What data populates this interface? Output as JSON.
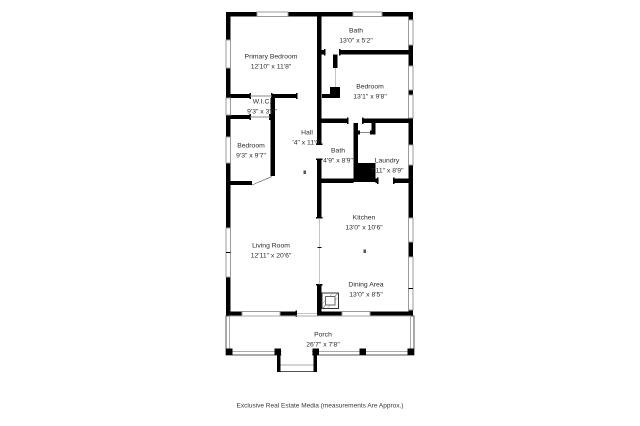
{
  "colors": {
    "wall": "#000000",
    "window_line": "#9b9b9b",
    "text": "#2b2b2b",
    "background": "#ffffff"
  },
  "rooms": [
    {
      "id": "bath-top",
      "name": "Bath",
      "dims": "13'0\" x 5'2\""
    },
    {
      "id": "primary-bedroom",
      "name": "Primary Bedroom",
      "dims": "12'10\" x 11'8\""
    },
    {
      "id": "bedroom-right",
      "name": "Bedroom",
      "dims": "13'1\" x 9'8\""
    },
    {
      "id": "wic",
      "name": "W.I.C.",
      "dims": "9'3\" x 3'0\""
    },
    {
      "id": "hall",
      "name": "Hall",
      "dims": "'4\" x 11'0\""
    },
    {
      "id": "bath-middle",
      "name": "Bath",
      "dims": "4'9\" x 8'9\""
    },
    {
      "id": "laundry",
      "name": "Laundry",
      "dims": "7'11\" x 8'9\""
    },
    {
      "id": "bedroom-left",
      "name": "Bedroom",
      "dims": "9'3\" x 9'7\""
    },
    {
      "id": "kitchen",
      "name": "Kitchen",
      "dims": "13'0\" x 10'6\""
    },
    {
      "id": "living-room",
      "name": "Living Room",
      "dims": "12'11\" x 20'6\""
    },
    {
      "id": "dining-area",
      "name": "Dining Area",
      "dims": "13'0\" x 8'5\""
    },
    {
      "id": "porch",
      "name": "Porch",
      "dims": "26'7\" x 7'8\""
    }
  ],
  "footer": {
    "credit": "Exclusive Real Estate Media (measurements Are Approx.)"
  }
}
